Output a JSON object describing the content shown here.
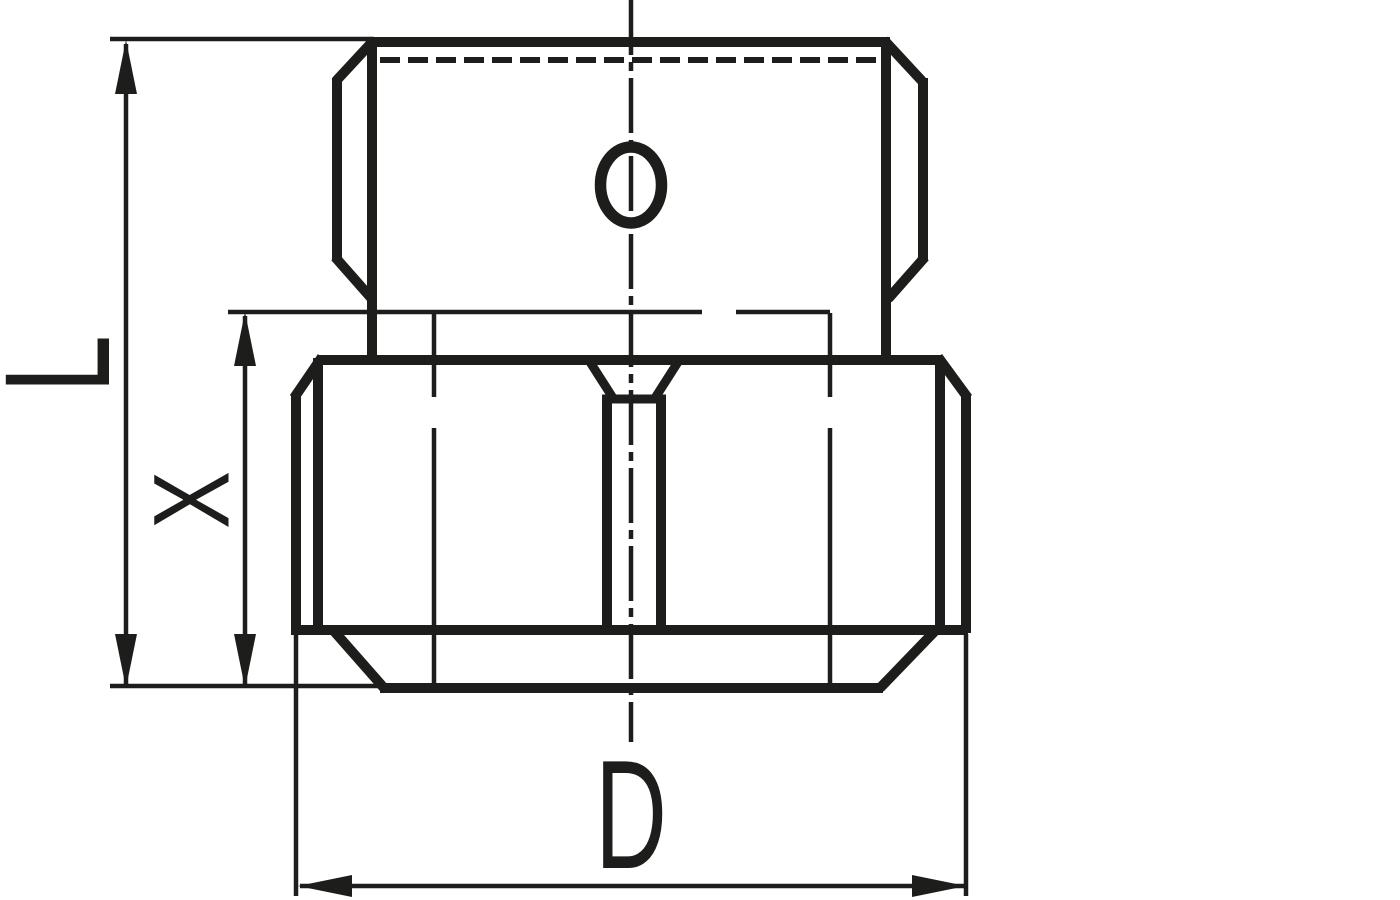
{
  "canvas": {
    "background": "#ffffff",
    "ink": "#1d1d1b"
  },
  "figure": {
    "kind": "technical line drawing",
    "subject": "hex blanking plug / cap fitting, side elevation with slotted socket",
    "labels": {
      "overall_length": "L",
      "lower_section_height": "X",
      "width_across": "D"
    }
  }
}
